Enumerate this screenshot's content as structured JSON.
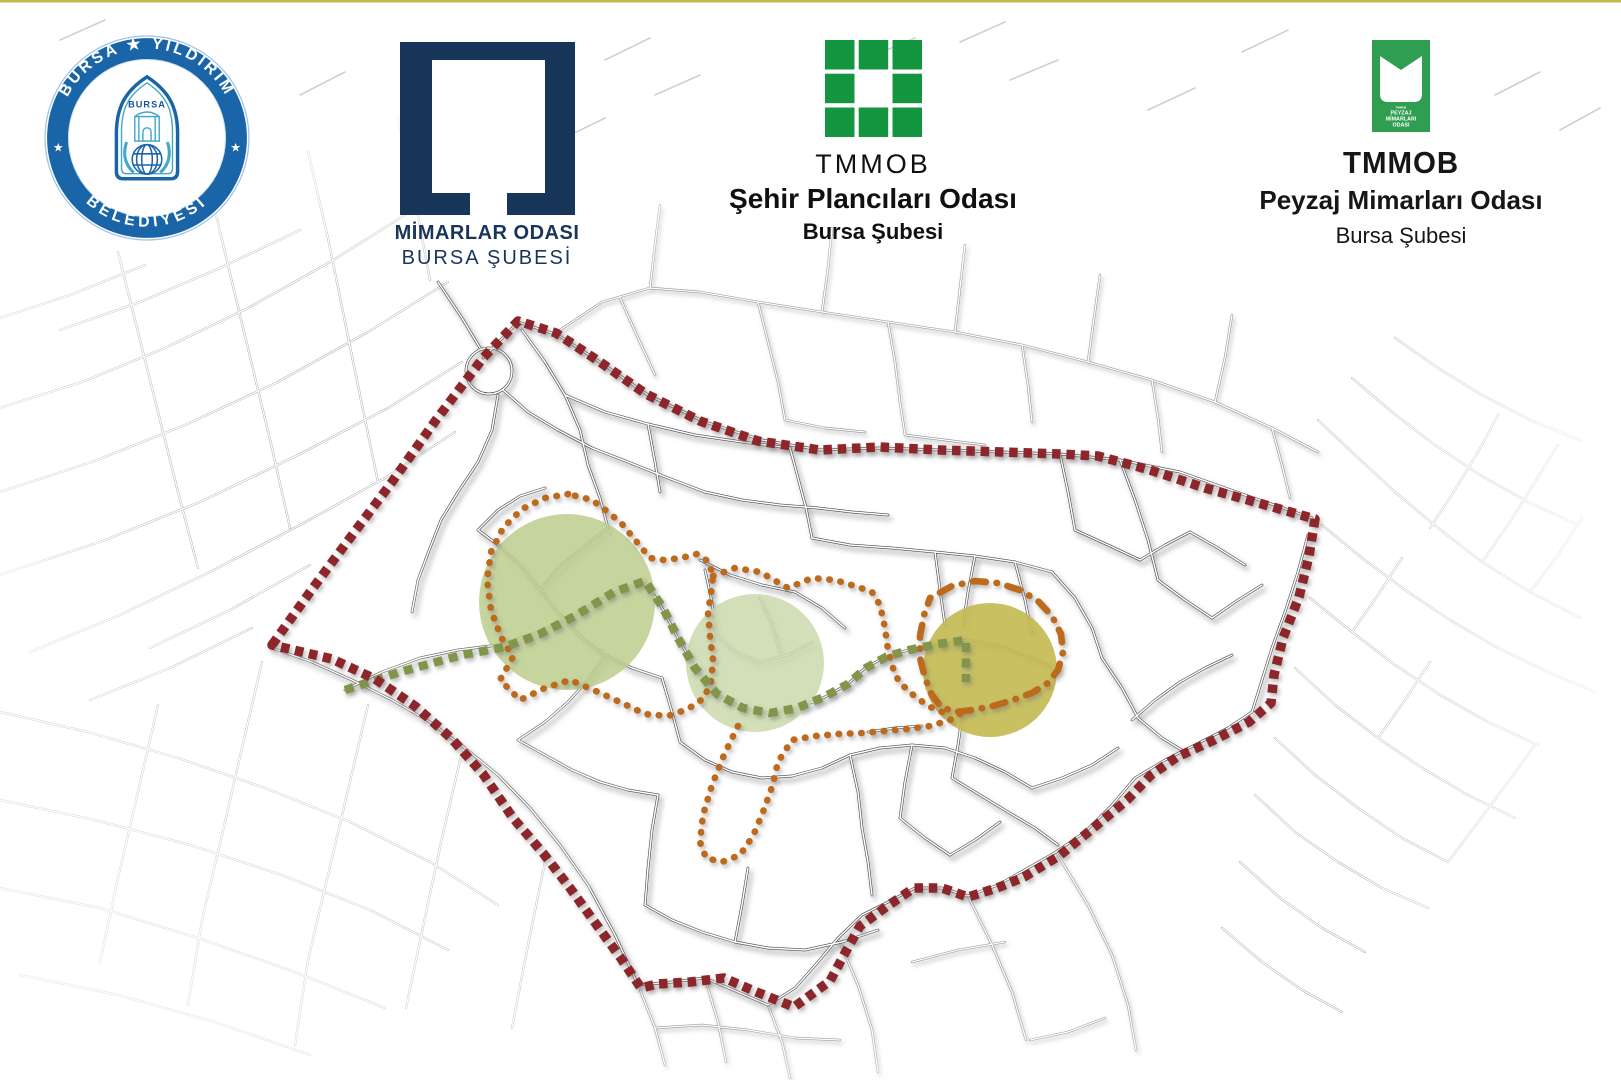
{
  "page": {
    "background": "#ffffff",
    "top_border_color": "#c3b84a"
  },
  "header": {
    "logos": [
      {
        "id": "bursa-yildirim-belediyesi",
        "ring_text_top": "BURSA ★ YILDIRIM",
        "ring_text_bottom": "BELEDİYESİ",
        "side_star": "★",
        "inner_city_label": "BURSA",
        "ring_color": "#1a64a8",
        "teal_color": "#3fa9c9",
        "navy_color": "#17549c"
      },
      {
        "id": "mimarlar-odasi",
        "line1": "MİMARLAR ODASI",
        "line2": "BURSA ŞUBESİ",
        "color": "#17365a"
      },
      {
        "id": "sehir-plancilari-odasi",
        "line1": "TMMOB",
        "line2": "Şehir Plancıları Odası",
        "line3": "Bursa Şubesi",
        "color": "#149540",
        "text_color": "#101010"
      },
      {
        "id": "peyzaj-mimarlari-odasi",
        "line1": "TMMOB",
        "line2": "Peyzaj Mimarları Odası",
        "line3": "Bursa Şubesi",
        "color": "#2f9e50",
        "badge_lines": [
          "TMMOB",
          "PEYZAJ",
          "MİMARLARI",
          "ODASI"
        ],
        "text_color": "#161616"
      }
    ]
  },
  "map": {
    "colors": {
      "street_dark": "#454545",
      "street_mid": "#8f8f8f",
      "street_light": "#ababab",
      "street_faint": "#d0d0d0",
      "boundary": "#8d282a",
      "orange_route": "#bd6a1d",
      "green_route": "#81954c"
    },
    "boundary": {
      "points": "272,645 310,592 350,538 392,482 436,420 483,358 518,321 556,333 600,362 646,394 700,421 758,441 820,450 880,447 940,450 1002,452 1060,454 1098,456 1150,470 1205,488 1262,504 1315,519 1309,556 1299,597 1283,638 1274,675 1271,703 1249,722 1214,740 1177,757 1151,775 1127,800 1092,829 1059,856 1024,877 997,888 968,897 942,888 914,888 886,907 860,926 845,953 830,981 794,1007 759,993 724,978 690,982 657,984 641,988 620,957 596,924 570,888 543,853 513,818 483,774 451,738 415,706 375,679 332,659 272,645"
    },
    "green_route": {
      "points": "345,690 400,672 462,655 505,647 540,634 575,616 614,592 645,581 663,608 678,638 695,668 717,694 743,708 770,713 797,708 824,697 848,684 866,668 886,657 909,650 938,644 966,640 966,682"
    },
    "orange_paths": [
      {
        "name": "loop-around-circle-1",
        "dash": "0.5 10.8",
        "points": "568,494 545,498 522,509 503,528 491,552 487,580 491,610 501,637 513,657 500,680 520,700 545,688 570,680 598,692 622,703 645,714 668,716 688,709 704,698 711,682 713,660 710,636 708,612 711,594 713,576 709,562 697,554 681,558 664,560 650,558 636,541 622,524 608,512 592,500 568,494"
      },
      {
        "name": "connector-upper",
        "dash": "0.5 10.8",
        "points": "713,576 735,568 760,572 788,588 812,578 835,580 858,587 872,592 880,605 885,628 888,650 893,668 899,682 912,694 928,706 942,712"
      },
      {
        "name": "lower-zigzag",
        "dash": "0.5 10.8",
        "points": "738,726 724,755 712,785 703,815 700,842 706,858 722,862 740,855 753,836 763,812 772,787 778,762 792,740 815,736 838,734 862,733 885,731 908,729 930,726 950,720 963,712"
      },
      {
        "name": "loop-around-circle-3",
        "dash": "0.5 10.8 13 10.8",
        "points": "930,598 952,586 975,581 998,583 1020,590 1038,601 1052,616 1061,634 1063,652 1058,670 1048,683 1032,693 1013,700 993,706 973,710 955,712 941,707 932,695 925,678 920,658 920,636 924,615 930,598"
      }
    ],
    "circles": [
      {
        "name": "focus-circle-west",
        "cx": 567,
        "cy": 602,
        "r": 88,
        "fill": "#bccd8d",
        "opacity": 0.85
      },
      {
        "name": "focus-circle-center",
        "cx": 755,
        "cy": 663,
        "r": 69,
        "fill": "#cbd9ac",
        "opacity": 0.85
      },
      {
        "name": "focus-circle-east",
        "cx": 990,
        "cy": 670,
        "r": 67,
        "fill": "#c2b950",
        "opacity": 0.9
      }
    ],
    "roundabout": {
      "cx": 489,
      "cy": 371,
      "r": 23
    },
    "street_groups": [
      {
        "name": "inner-streets",
        "style": "dark",
        "lines": [
          "438,282 462,318 480,348",
          "498,395 492,430 478,462 458,492 441,520 430,548",
          "430,548 418,580 412,612",
          "503,390 528,412 558,430 592,448 628,462 668,478 705,492",
          "705,492 742,500 780,505 818,508",
          "522,330 545,362 565,395 580,430 588,465",
          "588,465 600,498 608,528",
          "565,395 605,412 648,424 695,435 742,442 790,448",
          "648,424 655,462 660,492",
          "790,448 798,478 806,508 812,538",
          "812,538 850,545 892,548 935,552 975,556 1015,562 1052,572",
          "935,552 940,590 945,625",
          "1015,562 1025,600 1032,635",
          "1052,572 1075,598 1092,628 1102,658",
          "1102,658 1122,688 1138,718",
          "1138,718 1162,738 1185,752",
          "818,508 852,512 888,515",
          "608,528 582,548 558,568 540,590",
          "540,590 520,565 498,545 478,530",
          "478,530 498,510 520,496 545,488",
          "540,590 560,615 582,638 605,655",
          "605,655 632,668 662,678",
          "605,655 588,680 568,702",
          "568,702 545,722 518,740",
          "518,740 545,755 572,770 600,782",
          "600,782 628,790 658,795",
          "658,795 652,830 648,868 645,905",
          "645,905 672,920 702,932 735,942 768,948",
          "768,948 805,950 842,942 878,930",
          "662,678 672,712 680,742",
          "680,742 705,760 732,772",
          "732,772 762,778 792,776",
          "792,776 822,768 850,755",
          "850,755 880,748 912,745 945,748",
          "945,748 975,758 1005,772 1032,788",
          "1032,788 1062,778 1092,765 1118,748",
          "850,755 858,792 862,828",
          "862,828 868,862 872,895",
          "735,942 742,905 748,868",
          "705,570 712,602 716,635",
          "716,635 736,652 760,662",
          "760,662 788,655 812,642",
          "760,598 772,625 780,652",
          "700,560 730,575 762,585 795,592",
          "795,592 822,608 845,628",
          "975,556 968,592 963,625",
          "963,710 958,745 952,778",
          "952,778 980,795 1008,812",
          "1008,812 1035,828 1058,845",
          "345,690 382,672 420,658 458,650 498,645 538,632 570,618 608,595 645,580",
          "645,580 662,608 678,638 695,668 716,694 742,708 770,713 798,708 825,697 848,684 865,668 885,657 908,650 938,644 968,640",
          "968,640 1000,646 1030,657 1058,670",
          "272,648 312,662 352,680 392,700 430,722 465,748 498,775",
          "498,775 530,808 560,845 588,885 615,935 638,985",
          "638,985 672,982 705,978",
          "705,978 738,992 768,1005",
          "768,1005 795,988 818,962 838,938",
          "838,938 862,915 888,902 915,888",
          "915,888 942,888 968,896",
          "968,896 998,885 1028,868 1056,852",
          "1056,852 1085,832 1112,805 1135,778",
          "1135,778 1165,760 1195,745 1228,728 1252,712",
          "1252,712 1262,680 1272,648",
          "1272,648 1285,612 1298,572 1308,535",
          "483,358 518,322 558,335 600,362 648,395 705,422 762,440 820,450 880,448 940,450 1002,452 1060,454 1120,460 1180,472 1245,495 1312,518",
          "1120,460 1135,500 1148,540 1158,580",
          "1158,580 1185,600 1212,618",
          "1212,618 1238,600 1262,585",
          "1060,454 1068,492 1075,530",
          "1075,530 1108,545 1140,560",
          "1140,560 1165,545 1190,532",
          "1190,532 1218,548 1245,565",
          "912,745 905,782 900,818",
          "900,818 925,838 950,855",
          "950,855 975,840 1000,822",
          "1232,655 1205,668 1180,682",
          "1180,682 1155,700 1132,720",
          "868,732 895,728 922,726"
        ]
      },
      {
        "name": "bottom-outside-streets",
        "style": "mid",
        "lines": [
          "640,990 655,1028 665,1065",
          "705,978 718,1022 726,1062",
          "768,1005 782,1042 790,1078",
          "838,938 858,985 872,1030 878,1072",
          "968,896 992,945 1012,992 1026,1040",
          "1056,852 1088,905 1112,955 1128,1005 1136,1050",
          "655,1028 702,1025 748,1030 795,1038 840,1040",
          "912,962 958,950 1005,942",
          "1030,1040 1068,1032 1105,1018"
        ]
      },
      {
        "name": "top-outside-blocks",
        "style": "mid",
        "lines": [
          "560,330 602,302 650,288 700,292 758,302 822,312 888,322 955,332 1022,345 1088,362 1152,380 1215,402 1272,428 1318,452",
          "620,298 638,338 655,375",
          "758,302 768,342 778,382 785,420",
          "888,322 895,362 900,402 905,435",
          "1022,345 1028,385 1032,422",
          "1152,380 1158,418 1162,452",
          "1272,428 1282,465 1290,498",
          "650,288 655,245 660,205",
          "822,312 828,268 832,228",
          "955,332 960,288 965,245",
          "1088,362 1094,318 1100,275",
          "1215,402 1225,358 1232,315",
          "905,435 945,440 985,445",
          "785,420 825,428 865,432"
        ]
      },
      {
        "name": "northwest-fan",
        "style": "light",
        "lines": [
          "0,408 82,382 165,348 248,308 330,262 405,215 470,170",
          "0,492 92,462 185,425 278,382 368,332 448,282",
          "0,575 100,542 200,502 298,455 388,408 462,362",
          "30,652 120,615 210,572 300,525 385,478 455,432",
          "118,252 138,332 158,412 178,492 198,568",
          "212,198 232,282 252,365 272,448 290,528",
          "308,152 328,238 345,322 362,405 378,482",
          "398,118 415,200 430,280",
          "60,330 140,302 220,268 300,230",
          "0,318 70,295 145,265",
          "150,648 230,610 310,565",
          "90,700 170,668 252,628"
        ]
      },
      {
        "name": "southwest-grid",
        "style": "light",
        "lines": [
          "0,712 88,732 178,758 265,788 350,822 430,862 498,905",
          "0,800 95,820 190,845 282,875 370,910 448,950",
          "0,888 100,908 198,938 295,972 385,1008",
          "20,975 118,995 215,1022 310,1055",
          "158,705 138,792 118,878 100,962",
          "262,662 242,748 222,835 202,920 188,1005",
          "368,705 348,790 328,875 308,960 295,1045",
          "462,752 442,838 424,922 406,1008",
          "545,862 528,945 512,1028"
        ]
      },
      {
        "name": "east-grid",
        "style": "light",
        "lines": [
          "1318,420 1355,455 1395,492 1438,528 1482,562 1530,592 1580,618",
          "1352,378 1392,412 1435,445 1480,475 1528,502 1578,525",
          "1395,338 1438,368 1482,395 1530,420 1580,440",
          "1322,525 1362,558 1405,590 1450,620 1498,648 1548,672 1595,692",
          "1310,598 1352,632 1395,665 1440,695 1488,722 1538,745",
          "1295,668 1335,705 1378,738 1422,768 1468,795 1515,818",
          "1275,738 1315,775 1358,808 1402,838 1448,862",
          "1430,528 1455,490 1478,452 1498,415",
          "1482,562 1510,522 1535,482 1558,445",
          "1530,592 1558,555 1582,518",
          "1352,632 1378,595 1402,558",
          "1378,738 1405,700 1430,662",
          "1448,862 1478,822 1508,782 1535,745",
          "1255,795 1295,832 1338,862 1382,888 1428,908",
          "1240,862 1280,898 1322,928 1365,952",
          "1222,928 1262,962 1302,990 1342,1012"
        ]
      },
      {
        "name": "header-residual-ticks",
        "style": "faint",
        "lines": [
          "300,95 345,72",
          "605,60 650,38",
          "655,95 700,75",
          "960,42 1005,22",
          "1010,80 1058,60",
          "1148,110 1195,88",
          "1242,52 1288,30",
          "1495,95 1540,72",
          "560,140 605,118",
          "60,40 105,20",
          "1560,130 1600,108",
          "875,55 915,38"
        ]
      }
    ]
  }
}
